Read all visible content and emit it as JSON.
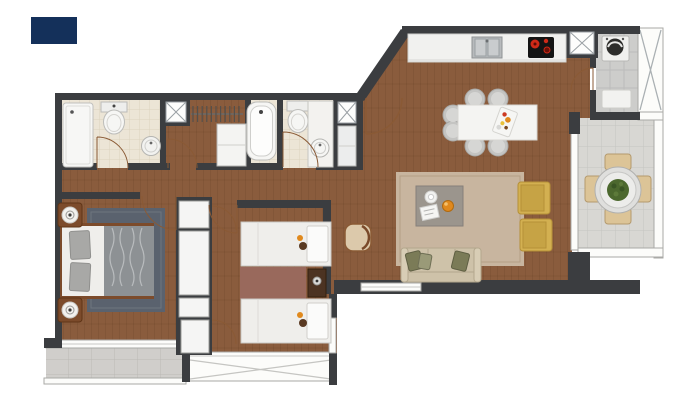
{
  "meta": {
    "type": "apartment-floor-plan",
    "width_px": 697,
    "height_px": 405,
    "visible_text": ""
  },
  "palette": {
    "background": "#ffffff",
    "logo_navy": "#14305a",
    "wall": "#3b3d40",
    "wood": "#8a5c3d",
    "bath_floor": "#ece5d6",
    "tile_floor": "#d8d7d3",
    "paver_floor": "#d0cecb",
    "laundry_floor": "#cdcdcb",
    "fixture_white": "#f6f6f4",
    "window_white": "#fcfcfa",
    "rug_living": "#c8b59f",
    "rug_master": "#5a626e",
    "rug_kids": "#99695c",
    "sofa": "#cec2a9",
    "pillow_olive": "#7b7b57",
    "armchair_yellow": "#d3b051",
    "coffee_table": "#9b958d",
    "stool_gray": "#c4c4c2",
    "table_white": "#f4f4f2",
    "cooktop_black": "#141414",
    "burner_red": "#cf2a18",
    "appliance_gray": "#b7babc",
    "terrace_chair": "#dcc497",
    "plant_green": "#4c682e",
    "door_arc": "#8a5a35",
    "bed_white": "#efeeeb",
    "duvet_gray": "#8d9194",
    "pillow_gray": "#a8a8a6",
    "furniture_wood": "#7c4b2b",
    "accent_orange": "#e0891d"
  },
  "plan": {
    "rooms": [
      {
        "id": "bathroom-1",
        "furniture": [
          "shower",
          "toilet",
          "washbasin"
        ]
      },
      {
        "id": "walk-in-closet",
        "furniture": [
          "hanging-rail",
          "cabinet"
        ]
      },
      {
        "id": "bathroom-2",
        "furniture": [
          "bathtub",
          "toilet",
          "washbasin",
          "cabinet"
        ]
      },
      {
        "id": "entry-hall",
        "furniture": [
          "entry-door",
          "service-shaft"
        ]
      },
      {
        "id": "kitchen",
        "furniture": [
          "counter",
          "double-sink",
          "cooktop"
        ]
      },
      {
        "id": "dining-area",
        "furniture": [
          "dining-table",
          "six-stools",
          "serving-tray"
        ]
      },
      {
        "id": "living-area",
        "furniture": [
          "sofa",
          "coffee-table",
          "two-armchairs",
          "side-chair",
          "rug"
        ]
      },
      {
        "id": "master-bedroom",
        "furniture": [
          "double-bed",
          "two-nightstands",
          "rug",
          "wardrobe-column"
        ]
      },
      {
        "id": "second-bedroom",
        "furniture": [
          "two-single-beds",
          "nightstand",
          "rug",
          "closet-doors"
        ]
      },
      {
        "id": "laundry",
        "furniture": [
          "washing-machine",
          "mat"
        ]
      },
      {
        "id": "terrace",
        "furniture": [
          "round-table",
          "potted-plant",
          "four-chairs"
        ]
      },
      {
        "id": "balcony",
        "furniture": []
      },
      {
        "id": "bay-window",
        "furniture": []
      },
      {
        "id": "service-shafts",
        "furniture": [
          "shaft",
          "shaft",
          "shaft"
        ]
      }
    ]
  }
}
